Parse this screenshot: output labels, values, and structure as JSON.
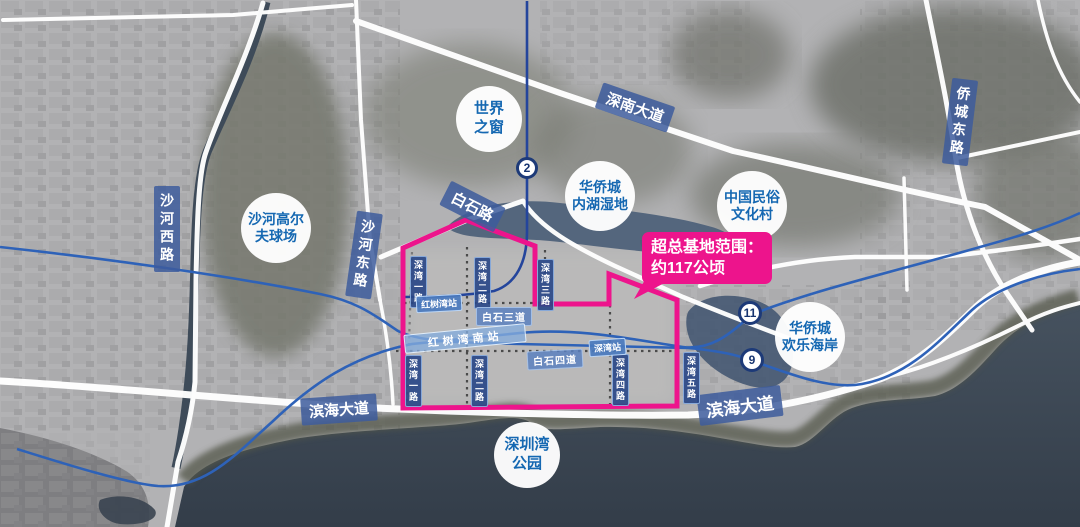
{
  "callout": {
    "line1": "超总基地范围：",
    "line2": "约117公顷"
  },
  "pois": {
    "world_window": {
      "line1": "世界",
      "line2": "之窗"
    },
    "oct_wetland": {
      "line1": "华侨城",
      "line2": "内湖湿地"
    },
    "folk_culture_village": {
      "line1": "中国民俗",
      "line2": "文化村"
    },
    "shahe_golf": {
      "line1": "沙河高尔",
      "line2": "夫球场"
    },
    "oct_happy_coast": {
      "line1": "华侨城",
      "line2": "欢乐海岸"
    },
    "shenzhen_bay_park": {
      "line1": "深圳湾",
      "line2": "公园"
    }
  },
  "roads": {
    "shennan_avenue": "深南大道",
    "qiaocheng_east_road": "侨城东路",
    "shahe_west_road": "沙河西路",
    "shahe_east_road": "沙河东路",
    "baishi_road": "白石路",
    "binhai_avenue_west": "滨海大道",
    "binhai_avenue_east": "滨海大道",
    "baishi_3rd_street": "白石三道",
    "baishi_4th_street": "白石四道",
    "shenwan_1st_road": "深湾一路",
    "shenwan_2nd_road": "深湾二路",
    "shenwan_3rd_road": "深湾三路",
    "shenwan_4th_road": "深湾四路",
    "shenwan_5th_road": "深湾五路"
  },
  "stations": {
    "hongshuwan": "红树湾站",
    "hongshuwan_south": "红树湾南站",
    "shenwan": "深湾站"
  },
  "metro_badges": {
    "line_2": "2",
    "line_11": "11",
    "line_9": "9"
  },
  "colors": {
    "boundary": "#ED148C",
    "poi_text": "#1568B2",
    "metro_line": "#2E62B8",
    "road_label_bg": "#3D5C9C",
    "sea": "#3A4450"
  }
}
